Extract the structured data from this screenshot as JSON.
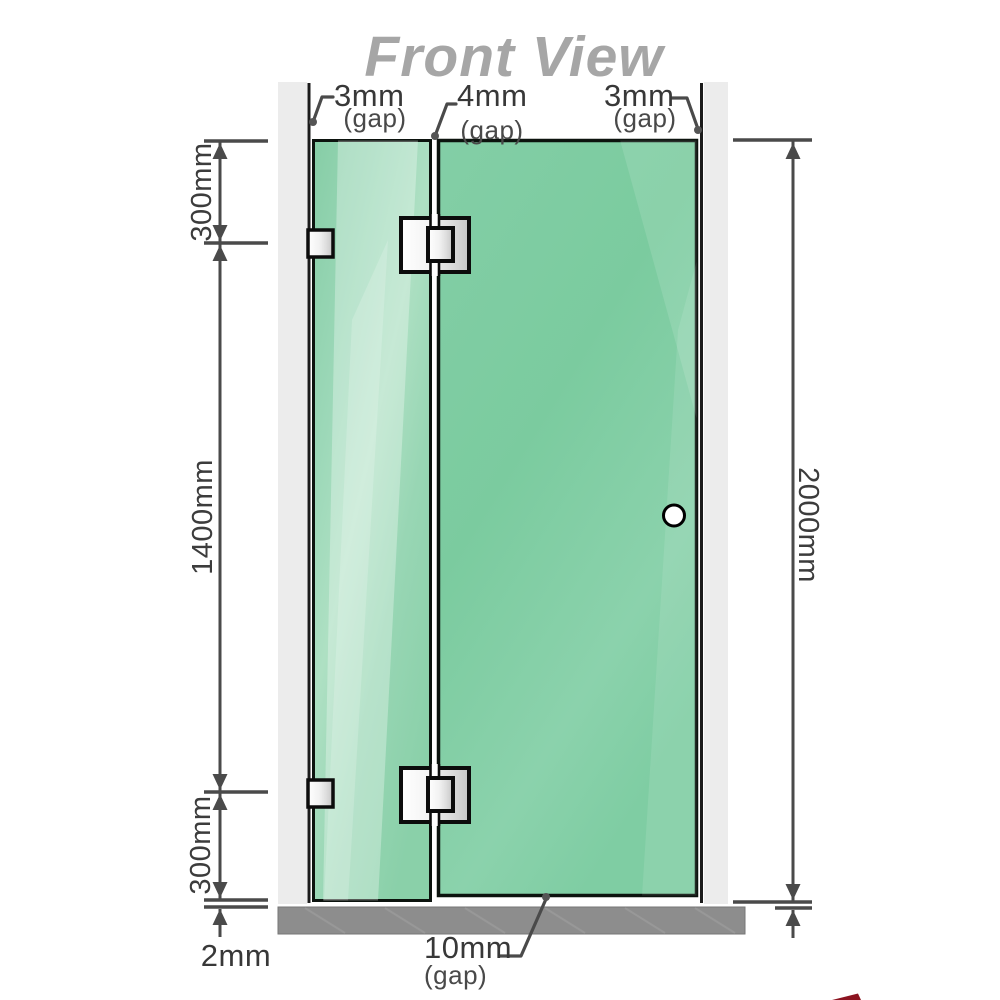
{
  "title": "Front View",
  "dimensions": {
    "left_top": "300mm",
    "left_middle": "1400mm",
    "left_bottom": "300mm",
    "left_floor_gap": "2mm",
    "right_height": "2000mm"
  },
  "gaps": {
    "top_left": {
      "value": "3mm",
      "label": "(gap)"
    },
    "top_middle": {
      "value": "4mm",
      "label": "(gap)"
    },
    "top_right": {
      "value": "3mm",
      "label": "(gap)"
    },
    "bottom_door": {
      "value": "10mm",
      "label": "(gap)"
    }
  },
  "colors": {
    "glass_green": "#8fd2ae",
    "glass_door_green": "#7ccb9f",
    "glass_highlight": "#b7e4cb",
    "wall_gray": "#ececec",
    "floor_gray": "#8d8d8d",
    "metal_silver": "#e6e6e6",
    "dimension_line": "#4a4a4a",
    "title_gray": "#a6a6a6",
    "logo_red": "#8c1420"
  }
}
